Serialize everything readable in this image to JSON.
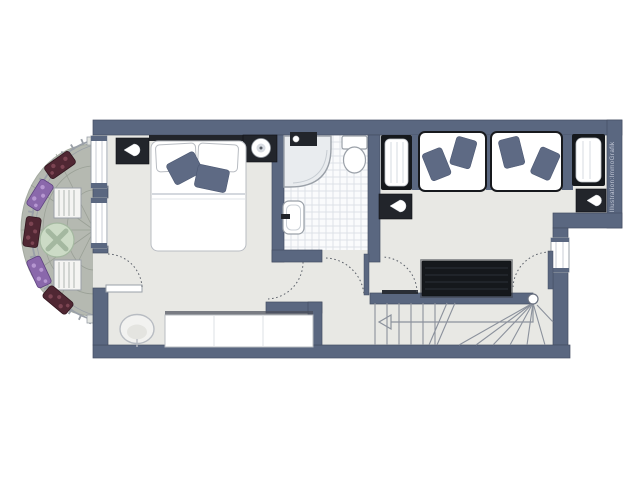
{
  "credit": {
    "text": "Illustration:ImmoGrafik"
  },
  "palette": {
    "wall": "#5a6780",
    "wall_edge": "#454f63",
    "floor": "#e8e8e4",
    "bath": "#fafbfc",
    "tile": "#dde2e7",
    "balcony": "#b5b9b1",
    "joint": "#9aa096",
    "rail": "#9aa0a8",
    "dark": "#22252b",
    "darker": "#15181c",
    "linen": "#ffffff",
    "linen_edge": "#b8bcc2",
    "cushion": "#5e6a84",
    "green": "#ccdbc6",
    "green_x": "#a4b8a0",
    "maroon": "#502733",
    "maroon_dot": "#7c4452",
    "purple": "#8a68ab",
    "purple_dot": "#b697d1",
    "line": "#8b919c",
    "arc": "#5a5f68",
    "credit": "#c2c8d6"
  },
  "plan": {
    "rooms": [
      "balcony",
      "bedroom",
      "bathroom",
      "twin-bedroom",
      "hallway",
      "staircase"
    ],
    "furniture": {
      "balcony": [
        "round-table",
        "bench",
        "bench",
        "flower-planter",
        "flower-planter",
        "flower-planter",
        "flower-planter",
        "flower-planter"
      ],
      "bedroom": [
        "double-bed",
        "nightstand",
        "nightstand",
        "wardrobe",
        "armchair"
      ],
      "bathroom": [
        "shower",
        "toilet",
        "sink"
      ],
      "twin-bedroom": [
        "single-bed",
        "single-bed",
        "bench",
        "bench",
        "nightstand",
        "nightstand"
      ],
      "hallway": [
        "sideboard"
      ],
      "staircase": [
        "stairs",
        "direction-arrow"
      ]
    }
  }
}
